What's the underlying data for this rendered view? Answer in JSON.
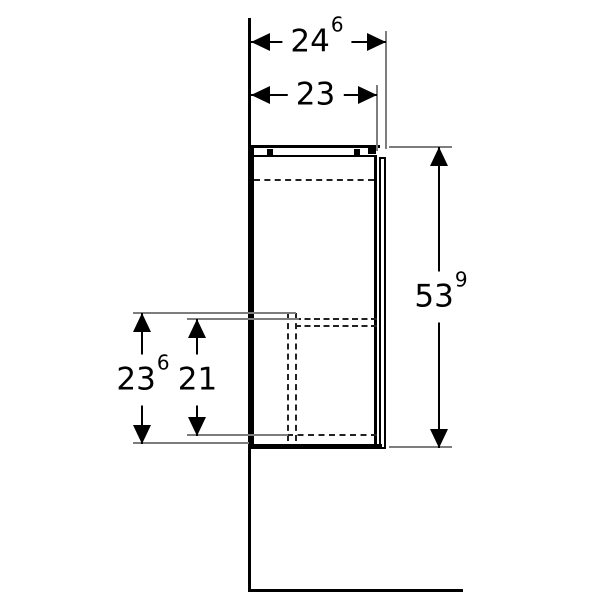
{
  "drawing": {
    "kind": "furniture-side-elevation-dimension-drawing",
    "background_color": "#ffffff",
    "line_color": "#000000",
    "extension_line_color": "#7d7d7d",
    "dims": {
      "depth_total": {
        "main": "24",
        "sup": "6"
      },
      "depth_body": {
        "main": "23",
        "sup": ""
      },
      "height_total": {
        "main": "53",
        "sup": "9"
      },
      "front_lower_height": {
        "main": "23",
        "sup": "6"
      },
      "interior_lower_height": {
        "main": "21",
        "sup": ""
      }
    }
  }
}
